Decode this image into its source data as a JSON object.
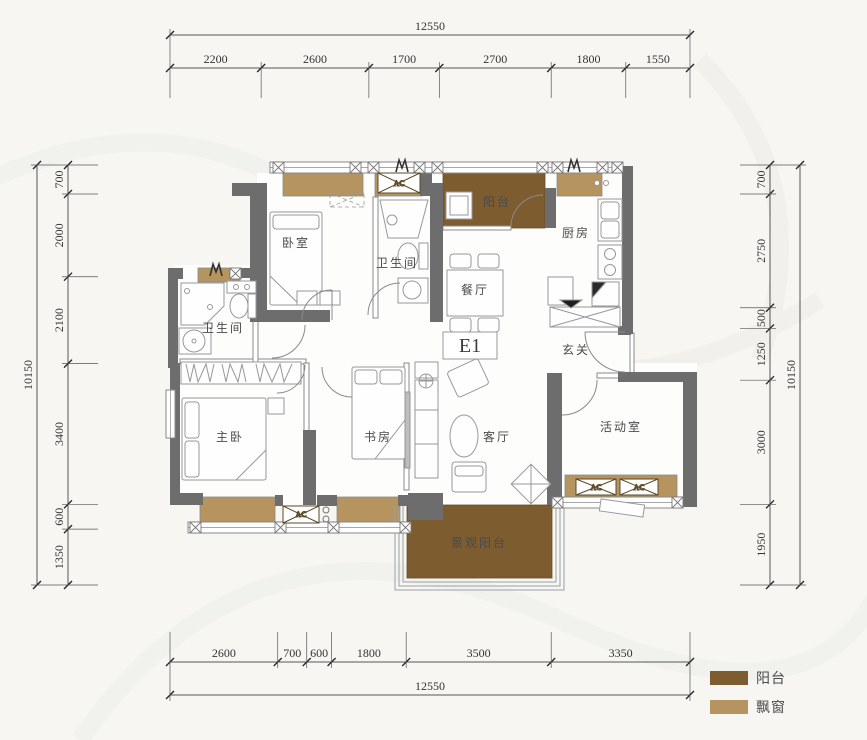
{
  "unit_label": "E1",
  "ac_label": "AC",
  "rooms": {
    "bedroom": "卧室",
    "bathroom_upper": "卫生间",
    "bathroom_lower": "卫生间",
    "dining": "餐厅",
    "balcony_top": "阳台",
    "kitchen": "厨房",
    "foyer": "玄关",
    "master_bedroom": "主卧",
    "study": "书房",
    "living_room": "客厅",
    "activity_room": "活动室",
    "view_balcony": "景观阳台"
  },
  "dimensions": {
    "top": {
      "total": "12550",
      "segments": [
        "2200",
        "2600",
        "1700",
        "2700",
        "1800",
        "1550"
      ]
    },
    "bottom": {
      "total": "12550",
      "segments": [
        "2600",
        "700",
        "600",
        "1800",
        "3500",
        "3350"
      ]
    },
    "left": {
      "total": "10150",
      "segments": [
        "700",
        "2000",
        "2100",
        "3400",
        "600",
        "1350"
      ]
    },
    "right": {
      "total": "10150",
      "segments": [
        "700",
        "2750",
        "500",
        "1250",
        "3000",
        "1950"
      ]
    }
  },
  "legend": {
    "items": [
      {
        "id": "balcony",
        "label": "阳台",
        "color": "#7d5c30"
      },
      {
        "id": "bay_window",
        "label": "飘窗",
        "color": "#b5945f"
      }
    ]
  },
  "colors": {
    "balcony": "#7d5c30",
    "bay_window": "#b5945f",
    "wall": "#6d6d6d",
    "line": "#8a8a8a",
    "furniture": "#98989a"
  }
}
